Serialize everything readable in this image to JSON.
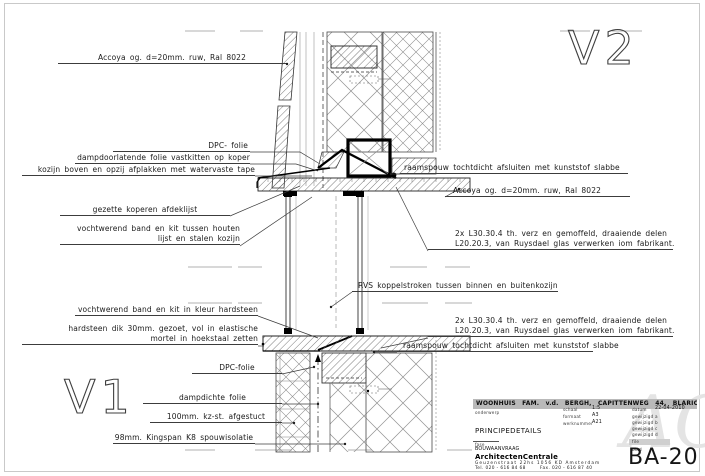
{
  "details": {
    "v1": "V1",
    "v2": "V2"
  },
  "labels": {
    "left": [
      {
        "line1": "Accoya og. d=20mm. ruw, Ral 8022"
      },
      {
        "line1": "DPC- folie"
      },
      {
        "line1": "dampdoorlatende folie vastkitten op koper"
      },
      {
        "line1": "kozijn boven en opzij afplakken met watervaste tape"
      },
      {
        "line1": "gezette koperen afdeklijst"
      },
      {
        "line1": "vochtwerend band en kit tussen houten",
        "line2": "lijst en stalen kozijn"
      },
      {
        "line1": "vochtwerend band en kit in kleur hardsteen"
      },
      {
        "line1": "hardsteen dik 30mm. gezoet, vol in elastische",
        "line2": "mortel in hoekstaal zetten"
      },
      {
        "line1": "DPC-folie"
      },
      {
        "line1": "dampdichte folie"
      },
      {
        "line1": "100mm. kz-st. afgestuct"
      },
      {
        "line1": "98mm. Kingspan K8 spouwisolatie"
      }
    ],
    "right": [
      {
        "line1": "raamspouw tochtdicht afsluiten met kunststof slabbe"
      },
      {
        "line1": "Accoya og. d=20mm. ruw, Ral 8022"
      },
      {
        "line1": "2x L30.30.4 th. verz en gemoffeld, draaiende delen",
        "line2": "L20.20.3, van Ruysdael glas verwerken iom fabrikant."
      },
      {
        "line1": "RVS koppelstroken tussen binnen en buitenkozijn"
      },
      {
        "line1": "2x L30.30.4 th. verz en gemoffeld, draaiende delen",
        "line2": "L20.20.3, van Ruysdael glas verwerken iom fabrikant."
      },
      {
        "line1": "raamspouw tochtdicht afsluiten met kunststof slabbe"
      }
    ]
  },
  "titleblock": {
    "project": "WOONHUIS FAM. v.d. BERGH, CAPITTENWEG 44, BLARICUM",
    "onderwerp_label": "onderwerp",
    "onderwerp": "PRINCIPEDETAILS",
    "schaal_label": "schaal",
    "schaal": "1:5",
    "formaat_label": "formaat",
    "formaat": "A3",
    "werknummer_label": "werknummer",
    "werknummer": "A21",
    "datum_label": "datum",
    "datum": "22-04-2010",
    "gewijzigd_a": "gewijzigd a",
    "gewijzigd_b": "gewijzigd b",
    "gewijzigd_c": "gewijzigd c",
    "gewijzigd_d": "gewijzigd d",
    "file_label": "file",
    "blad_label": "blad",
    "fase_label": "fase",
    "fase": "BOUWAANVRAAG",
    "bureau": "ArchitectenCentrale",
    "adres": "Geuzenstraat 22hs   1056 KD Amsterdam",
    "telefoon": "Tel. 020 - 616 84 68",
    "fax": "Fax. 020 - 616 87 40",
    "bladnummer": "BA-20",
    "logo": "AC"
  },
  "colors": {
    "line": "#3c3c3c",
    "break_line": "#b0b0b0",
    "titlebar_bg": "#b9b9b9",
    "watermark": "#e4e4e4"
  }
}
